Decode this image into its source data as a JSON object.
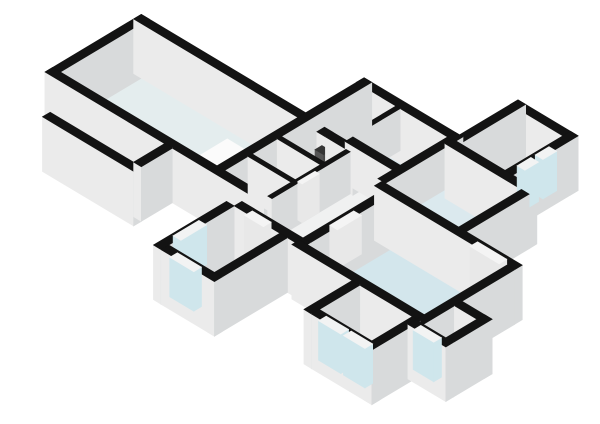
{
  "view": {
    "title": "3d-floorplan-render",
    "width": 600,
    "height": 424,
    "background": "#ffffff"
  },
  "projection": {
    "origin_x": 45,
    "origin_y": 114,
    "axis_scale": 0.86,
    "depth_scale": 0.515,
    "height_scale": 0.84,
    "wall_height": 50,
    "exterior_base": -15,
    "window_height": 47,
    "door_height": 46
  },
  "palette": {
    "wall_top": "#131313",
    "wall_face_sw": "#ebebeb",
    "wall_face_se": "#d8dadb",
    "glass_face": "#cfe6ec",
    "glass_top": "#f2f3f3",
    "door_top": "#f4f4f4",
    "door_face": "#e8e8e8",
    "fixture_white_top": "#fbfbfb",
    "fixture_white_sw": "#e9e9e9",
    "fixture_white_se": "#dadada",
    "fixture_dark_top": "#353535",
    "fixture_dark_sw": "#555555",
    "fixture_dark_se": "#464646",
    "shower_top": "#28a1c5",
    "shower_side": "#1a7a99"
  },
  "rooms": [
    {
      "name": "floor-living-room",
      "rect": [
        9,
        191,
        9,
        103
      ],
      "color": "#e4edee"
    },
    {
      "name": "floor-west-room-1",
      "rect": [
        51,
        92,
        -36,
        0
      ],
      "color": "#eff1f1"
    },
    {
      "name": "floor-west-room-2",
      "rect": [
        97,
        139,
        -36,
        0
      ],
      "color": "#eff1f1"
    },
    {
      "name": "floor-closet-1",
      "rect": [
        200,
        250,
        9,
        36
      ],
      "color": "#f1f2f2"
    },
    {
      "name": "floor-closet-2",
      "rect": [
        200,
        250,
        41,
        70
      ],
      "color": "#f1f2f2"
    },
    {
      "name": "floor-closet-3",
      "rect": [
        200,
        250,
        75,
        100
      ],
      "color": "#f1f2f2"
    },
    {
      "name": "floor-hallway",
      "poly": [
        [
          255,
          -11
        ],
        [
          311,
          -11
        ],
        [
          311,
          81
        ],
        [
          302,
          81
        ],
        [
          302,
          107
        ],
        [
          255,
          107
        ]
      ],
      "color": "#f0f1f1"
    },
    {
      "name": "floor-shower-room",
      "rect": [
        200,
        237,
        108,
        171
      ],
      "color": "#f0f2f2"
    },
    {
      "name": "floor-toilet-room",
      "rect": [
        242,
        297,
        116,
        171
      ],
      "color": "#dbe9ee"
    },
    {
      "name": "floor-right-room",
      "rect": [
        311,
        363,
        177,
        239
      ],
      "color": "#f1f2f2"
    },
    {
      "name": "floor-mid-bedroom",
      "rect": [
        306,
        391,
        99,
        163
      ],
      "color": "#dbe9ee"
    },
    {
      "name": "floor-big-bedroom",
      "rect": [
        320,
        456,
        -15,
        81
      ],
      "color": "#d3e6ec"
    },
    {
      "name": "floor-south-room",
      "rect": [
        390,
        451,
        -71,
        -24
      ],
      "color": "#d3e6ec"
    },
    {
      "name": "floor-southwest-room",
      "rect": [
        240,
        293,
        -96,
        -20
      ],
      "color": "#cfe3ea"
    },
    {
      "name": "floor-southeast-alcove",
      "rect": [
        465,
        491,
        -25,
        11
      ],
      "color": "#eff1f1"
    }
  ],
  "walls": [
    {
      "name": "wall-living-nw",
      "rect": [
        0,
        9,
        0,
        112
      ],
      "ext": true
    },
    {
      "name": "wall-living-ne",
      "rect": [
        0,
        200,
        103,
        112
      ],
      "ext": true
    },
    {
      "name": "wall-living-sw",
      "rect": [
        0,
        255,
        0,
        9
      ],
      "ext": true
    },
    {
      "name": "wall-living-se",
      "rect": [
        191,
        200,
        0,
        180
      ],
      "ext": true
    },
    {
      "name": "wall-shower-ne",
      "rect": [
        191,
        302,
        171,
        180
      ],
      "ext": true
    },
    {
      "name": "wall-westrooms-nw",
      "rect": [
        42,
        51,
        -36,
        0
      ],
      "ext": true
    },
    {
      "name": "wall-westrooms-sw",
      "rect": [
        42,
        148,
        -45,
        -36
      ],
      "ext": true
    },
    {
      "name": "wall-westrooms-se",
      "rect": [
        139,
        148,
        -36,
        0
      ],
      "ext": true
    },
    {
      "name": "wall-hall-sw",
      "rect": [
        240,
        320,
        -20,
        -11
      ],
      "ext": true
    },
    {
      "name": "wall-rightroom-nw",
      "rect": [
        302,
        311,
        168,
        248
      ],
      "ext": true
    },
    {
      "name": "wall-rightroom-ne",
      "rect": [
        302,
        372,
        239,
        248
      ],
      "ext": true
    },
    {
      "name": "wall-rightroom-se",
      "rect": [
        363,
        372,
        168,
        248
      ],
      "ext": true
    },
    {
      "name": "wall-midbedroom-ne",
      "rect": [
        302,
        400,
        163,
        172
      ],
      "ext": true
    },
    {
      "name": "wall-midbedroom-se",
      "rect": [
        391,
        400,
        90,
        163
      ],
      "ext": true
    },
    {
      "name": "wall-bigbedroom-ne",
      "rect": [
        302,
        465,
        81,
        90
      ],
      "ext": true
    },
    {
      "name": "wall-bigbedroom-nw",
      "rect": [
        311,
        320,
        -20,
        81
      ],
      "ext": true
    },
    {
      "name": "wall-bigbedroom-se",
      "rect": [
        456,
        465,
        -25,
        81
      ],
      "ext": true
    },
    {
      "name": "wall-bigbedroom-sw",
      "rect": [
        311,
        465,
        -24,
        -15
      ],
      "ext": true
    },
    {
      "name": "wall-southroom-nw",
      "rect": [
        381,
        390,
        -80,
        -24
      ],
      "ext": true
    },
    {
      "name": "wall-southroom-sw",
      "rect": [
        390,
        460,
        -80,
        -71
      ],
      "ext": true
    },
    {
      "name": "wall-southroom-se",
      "rect": [
        451,
        460,
        -80,
        -24
      ],
      "ext": true
    },
    {
      "name": "wall-alcove-sw",
      "rect": [
        456,
        500,
        -34,
        -25
      ],
      "ext": true
    },
    {
      "name": "wall-alcove-se",
      "rect": [
        491,
        500,
        -25,
        20
      ],
      "ext": true
    },
    {
      "name": "wall-alcove-ne",
      "rect": [
        465,
        500,
        11,
        20
      ],
      "ext": true
    },
    {
      "name": "wall-swroom-nw",
      "rect": [
        231,
        240,
        -105,
        -20
      ],
      "ext": true
    },
    {
      "name": "wall-swroom-sw",
      "rect": [
        240,
        302,
        -105,
        -96
      ],
      "ext": true
    },
    {
      "name": "wall-swroom-se",
      "rect": [
        293,
        302,
        -105,
        -20
      ],
      "ext": true
    },
    {
      "name": "wall-westrooms-divider",
      "rect": [
        92,
        97,
        -36,
        0
      ],
      "ext": false
    },
    {
      "name": "wall-closets-se",
      "rect": [
        250,
        255,
        9,
        100
      ],
      "ext": false
    },
    {
      "name": "wall-closets-div-1",
      "rect": [
        200,
        250,
        36,
        41
      ],
      "ext": false
    },
    {
      "name": "wall-closets-div-2",
      "rect": [
        200,
        250,
        70,
        75
      ],
      "ext": false
    },
    {
      "name": "wall-closets-ne-a",
      "rect": [
        200,
        216,
        100,
        109
      ],
      "ext": false
    },
    {
      "name": "wall-closets-ne-b",
      "rect": [
        216,
        226,
        100,
        109
      ],
      "ext": false
    },
    {
      "name": "wall-closets-ne-c",
      "rect": [
        226,
        258,
        100,
        109
      ],
      "ext": false
    },
    {
      "name": "wall-shower-se",
      "rect": [
        237,
        242,
        108,
        171
      ],
      "ext": false
    },
    {
      "name": "wall-toilet-sw",
      "rect": [
        242,
        302,
        107,
        116
      ],
      "ext": false
    },
    {
      "name": "wall-toilet-se",
      "rect": [
        297,
        306,
        90,
        180
      ],
      "ext": false
    }
  ],
  "windows": [
    {
      "name": "window-westroom-a",
      "rect": [
        42,
        51,
        -29,
        -19
      ]
    },
    {
      "name": "window-westroom-b",
      "rect": [
        42,
        51,
        -15,
        -5
      ]
    },
    {
      "name": "window-rightroom-a",
      "rect": [
        363,
        372,
        186,
        202
      ]
    },
    {
      "name": "window-rightroom-b",
      "rect": [
        363,
        372,
        207,
        223
      ]
    },
    {
      "name": "window-swroom-nw",
      "rect": [
        231,
        240,
        -82,
        -52
      ]
    },
    {
      "name": "window-swroom-sw",
      "rect": [
        250,
        278,
        -105,
        -96
      ]
    },
    {
      "name": "window-southroom-a",
      "rect": [
        398,
        424,
        -80,
        -71
      ]
    },
    {
      "name": "window-southroom-b",
      "rect": [
        427,
        452,
        -80,
        -71
      ]
    },
    {
      "name": "window-alcove-door",
      "rect": [
        462,
        486,
        -34,
        -25
      ]
    }
  ],
  "doors": [
    {
      "name": "door-bigbedroom-double",
      "rect": [
        413,
        447,
        81,
        90
      ]
    },
    {
      "name": "door-hall-bigbedroom",
      "rect": [
        311,
        320,
        20,
        48
      ]
    },
    {
      "name": "door-closet-hall",
      "rect": [
        250,
        255,
        44,
        64
      ]
    },
    {
      "name": "door-hall-swroom",
      "rect": [
        252,
        274,
        -20,
        -11
      ]
    }
  ],
  "fixtures": [
    {
      "name": "fixture-sideboard",
      "rect": [
        140,
        168,
        40,
        72
      ],
      "h": 12,
      "style": "white"
    },
    {
      "name": "fixture-washbasin",
      "rect": [
        270,
        284,
        150,
        164
      ],
      "h": 16,
      "style": "white"
    },
    {
      "name": "fixture-wall-unit",
      "rect": [
        216,
        226,
        98,
        106
      ],
      "h": 30,
      "style": "dark"
    },
    {
      "name": "fixture-shower-pan",
      "rect": [
        204,
        233,
        142,
        170
      ],
      "h": 3,
      "style": "shower"
    }
  ]
}
